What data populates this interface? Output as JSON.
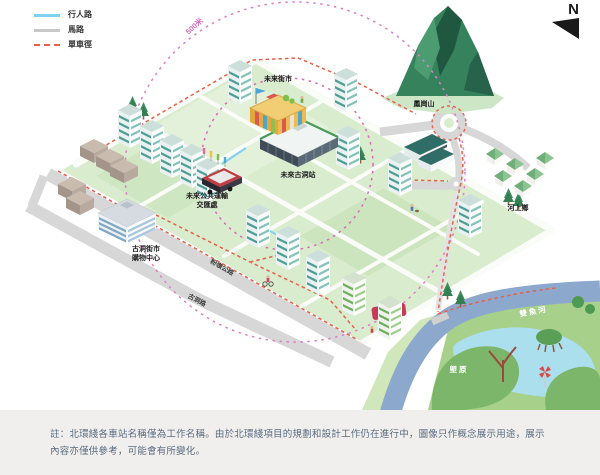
{
  "legend": {
    "items": [
      {
        "name": "pedestrian-path",
        "label": "行人路"
      },
      {
        "name": "road",
        "label": "馬路"
      },
      {
        "name": "cycle-track",
        "label": "單車徑"
      }
    ]
  },
  "compass": {
    "north": "N"
  },
  "map": {
    "labels": {
      "future_market": "未來街市",
      "future_station": "未來古洞站",
      "pti_line1": "未來公共運輸",
      "pti_line2": "交匯處",
      "mall_line1": "古洞街市",
      "mall_line2": "購物中心",
      "mountain": "鳳崗山",
      "village": "河上鄉",
      "river": "雙魚河",
      "wetland": "塱原",
      "road_kwu_tung": "古洞路",
      "road_fanling": "粉嶺公路",
      "radius_top": "500米",
      "radius_bottom": "500米"
    }
  },
  "colors": {
    "pedestrian": "#7fd2f0",
    "road": "#c8c8c8",
    "cycle": "#e8614c",
    "radius_ring": "#d96bb8",
    "radius_badge": "#c9375a",
    "site_green": "#d9ecce",
    "river_blue": "#8ca8cd"
  },
  "note": "註：北環綫各車站名稱僅為工作名稱。由於北環綫項目的規劃和設計工作仍在進行中，圖像只作概念展示用途，展示內容亦僅供參考，可能會有所變化。"
}
